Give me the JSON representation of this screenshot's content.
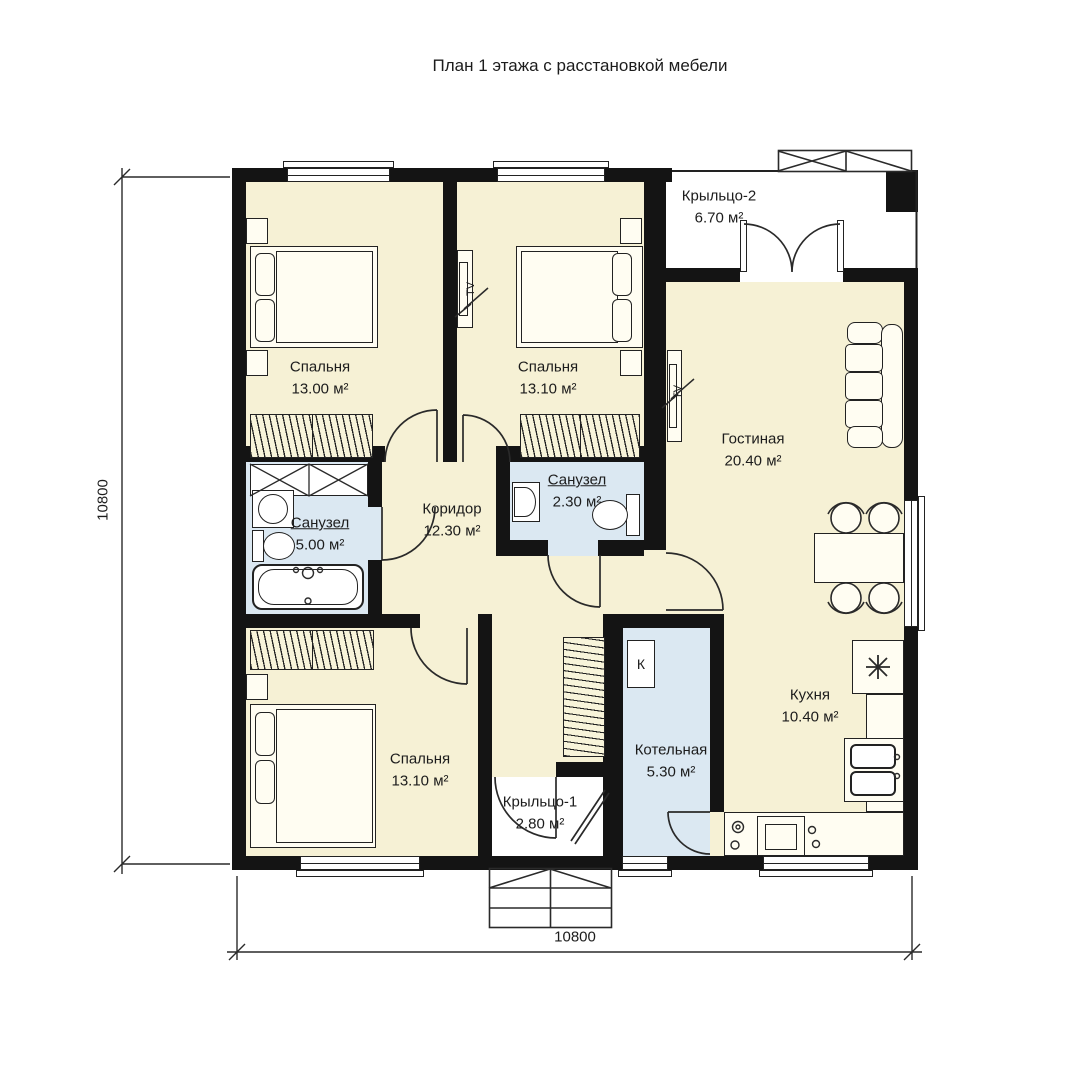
{
  "title": "План 1 этажа с расстановкой мебели",
  "rooms": {
    "bedroom1": {
      "name": "Спальня",
      "area": "13.00 м²"
    },
    "bedroom2": {
      "name": "Спальня",
      "area": "13.10 м²"
    },
    "bedroom3": {
      "name": "Спальня",
      "area": "13.10 м²"
    },
    "living": {
      "name": "Гостиная",
      "area": "20.40 м²"
    },
    "corridor": {
      "name": "Коридор",
      "area": "12.30 м²"
    },
    "bath1": {
      "name": "Санузел",
      "area": "5.00 м²"
    },
    "bath2": {
      "name": "Санузел",
      "area": "2.30 м²"
    },
    "boiler": {
      "name": "Котельная",
      "area": "5.30 м²"
    },
    "kitchen": {
      "name": "Кухня",
      "area": "10.40 м²"
    },
    "porch1": {
      "name": "Крыльцо-1",
      "area": "2.80 м²"
    },
    "porch2": {
      "name": "Крыльцо-2",
      "area": "6.70 м²"
    }
  },
  "symbols": {
    "tv": "TV",
    "boiler": "К"
  },
  "dimensions": {
    "bottom": "10800",
    "left": "10800"
  },
  "colors": {
    "wall": "#141414",
    "floor": "#f6f1d5",
    "wet": "#dbe8f2",
    "line": "#222222",
    "paper": "#ffffff",
    "furn": "#fffdf2"
  }
}
